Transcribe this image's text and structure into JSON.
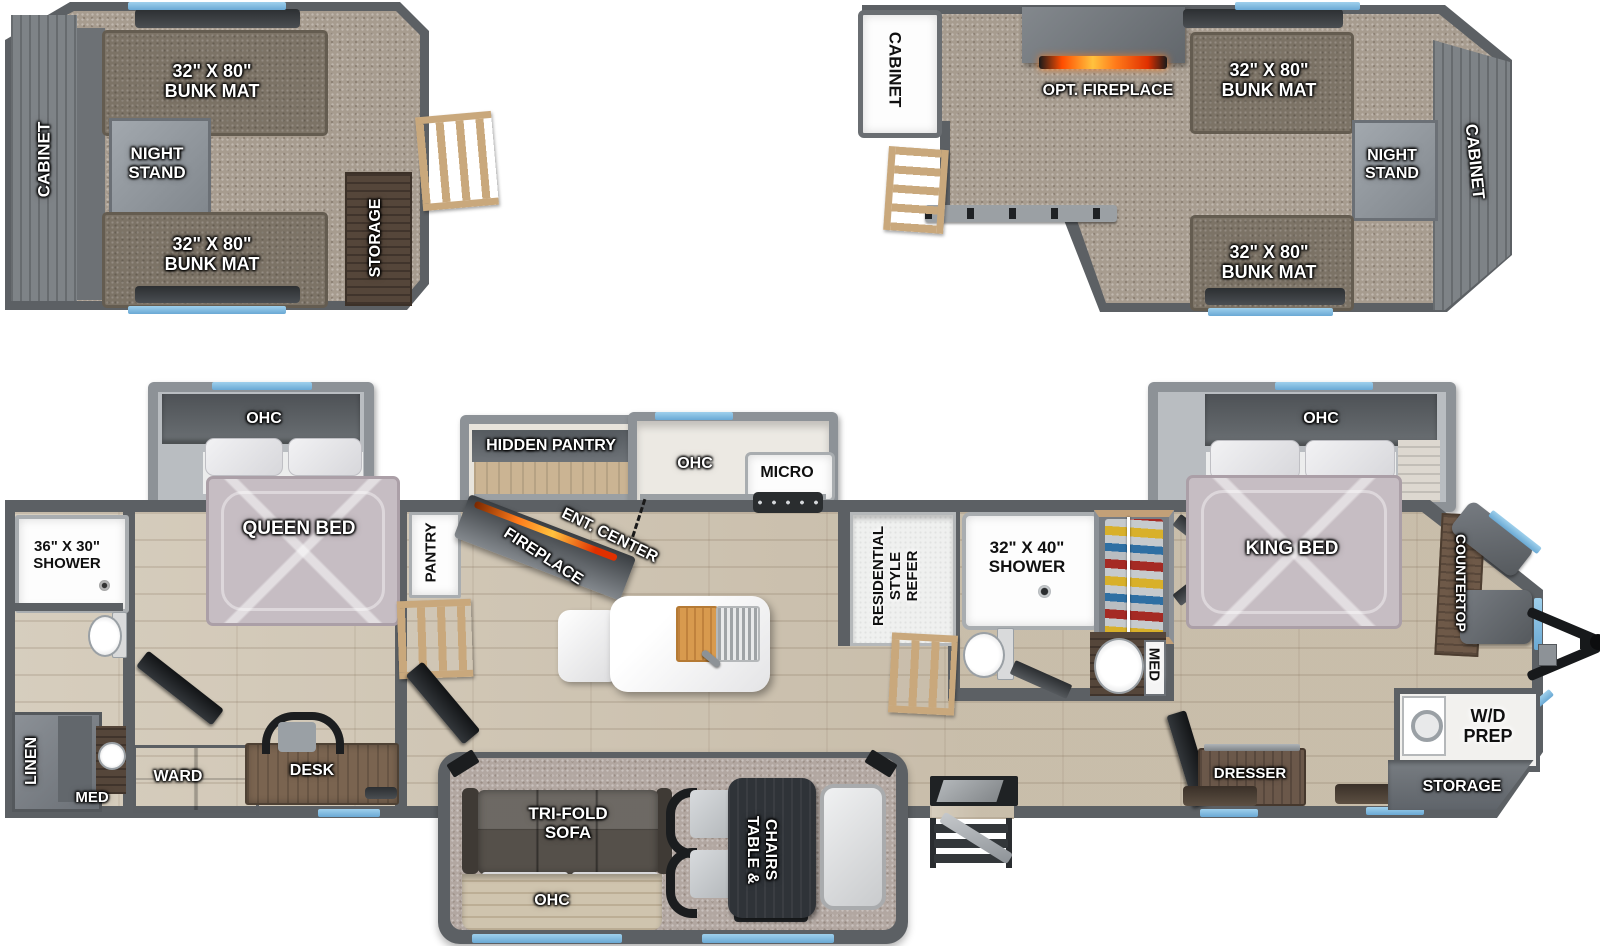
{
  "colors": {
    "wall": "#5c6064",
    "window_blue": "#6aa9d4",
    "fire_orange": "#ff7a1a",
    "accent_carpet": "#a79c8f"
  },
  "loft_left": {
    "cabinet": "CABINET",
    "bunk_top": "32\" X 80\"\nBUNK MAT",
    "night_stand": "NIGHT\nSTAND",
    "bunk_bottom": "32\" X 80\"\nBUNK MAT",
    "storage": "STORAGE"
  },
  "loft_right": {
    "cabinet_left": "CABINET",
    "opt_fireplace": "OPT. FIREPLACE",
    "bunk_top": "32\" X 80\"\nBUNK MAT",
    "night_stand": "NIGHT\nSTAND",
    "bunk_bottom": "32\" X 80\"\nBUNK MAT",
    "cabinet_right": "CABINET"
  },
  "bath_rear": {
    "shower": "36\" X 30\"\nSHOWER",
    "linen": "LINEN",
    "med": "MED"
  },
  "bedroom_rear": {
    "ohc": "OHC",
    "bed": "QUEEN BED",
    "ward": "WARD",
    "desk": "DESK"
  },
  "kitchen": {
    "pantry": "PANTRY",
    "hidden_pantry": "HIDDEN PANTRY",
    "fireplace": "FIREPLACE",
    "ent_center": "ENT. CENTER",
    "ohc": "OHC",
    "micro": "MICRO",
    "refer": "RESIDENTIAL\nSTYLE\nREFER"
  },
  "living": {
    "sofa": "TRI-FOLD\nSOFA",
    "ohc": "OHC",
    "table": "TABLE &\nCHAIRS"
  },
  "bath_mid": {
    "shower": "32\" X 40\"\nSHOWER",
    "med": "MED"
  },
  "bedroom_front": {
    "ohc": "OHC",
    "bed": "KING BED",
    "dresser": "DRESSER"
  },
  "front_cap": {
    "countertop": "COUNTERTOP",
    "wd_prep": "W/D\nPREP",
    "storage": "STORAGE"
  }
}
